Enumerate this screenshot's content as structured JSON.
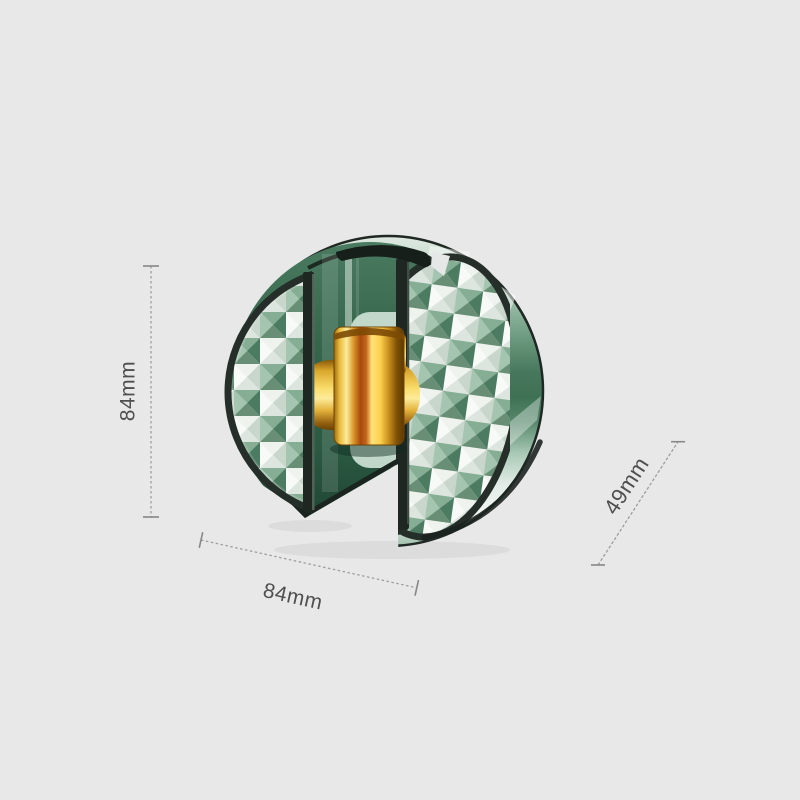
{
  "canvas": {
    "background_color": "#e8e8e8"
  },
  "product": {
    "name": "crystal diamond-pattern round holder, cutaway render",
    "colors": {
      "body_green": "#2e5d46",
      "rim_light_green": "#c2d8c9",
      "facet_white": "#eef3ee",
      "facet_green": "#6f9c82",
      "gold": "#f2c94c",
      "edge_dark": "#262e29"
    }
  },
  "dimensions": {
    "height": {
      "label": "84mm"
    },
    "width": {
      "label": "84mm"
    },
    "depth": {
      "label": "49mm"
    }
  },
  "annotation_style": {
    "line_color": "#9aa09b",
    "tick_color": "#878787",
    "text_color": "#4f4f4f"
  }
}
